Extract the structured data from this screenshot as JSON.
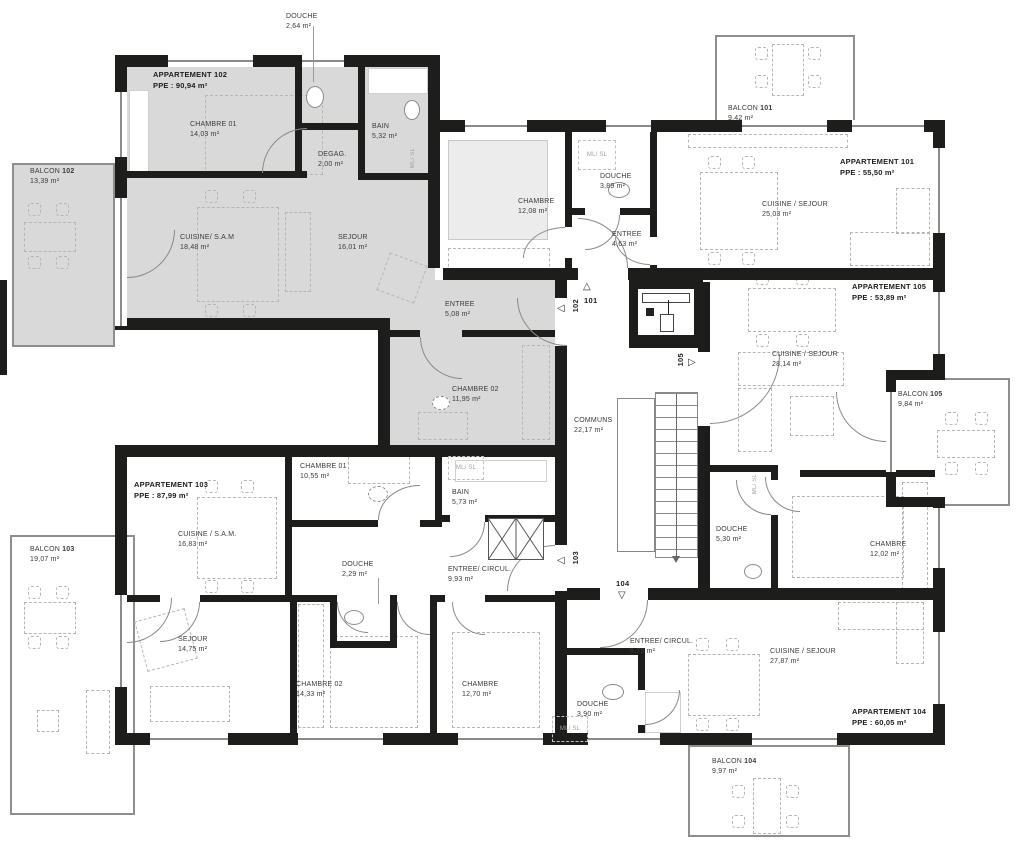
{
  "plan": {
    "apartments": {
      "a101": {
        "title": "APPARTEMENT 101",
        "ppe": "PPE : 55,50 m²"
      },
      "a102": {
        "title": "APPARTEMENT 102",
        "ppe": "PPE : 90,94 m²"
      },
      "a103": {
        "title": "APPARTEMENT 103",
        "ppe": "PPE : 87,99 m²"
      },
      "a104": {
        "title": "APPARTEMENT 104",
        "ppe": "PPE : 60,05 m²"
      },
      "a105": {
        "title": "APPARTEMENT 105",
        "ppe": "PPE : 53,89 m²"
      }
    },
    "rooms": {
      "douche_102_top": {
        "name": "DOUCHE",
        "area": "2,64 m²"
      },
      "chambre01_102": {
        "name": "CHAMBRE 01",
        "area": "14,03 m²"
      },
      "bain_102": {
        "name": "BAIN",
        "area": "5,32 m²"
      },
      "degag_102": {
        "name": "DEGAG.",
        "area": "2,00 m²"
      },
      "cuisine_102": {
        "name": "CUISINE/ S.A.M",
        "area": "18,48 m²"
      },
      "sejour_102": {
        "name": "SEJOUR",
        "area": "16,01 m²"
      },
      "entree_102": {
        "name": "ENTREE",
        "area": "5,08 m²"
      },
      "chambre02_102": {
        "name": "CHAMBRE 02",
        "area": "11,95 m²"
      },
      "chambre_101": {
        "name": "CHAMBRE",
        "area": "12,08 m²"
      },
      "douche_101": {
        "name": "DOUCHE",
        "area": "3,89 m²"
      },
      "entree_101": {
        "name": "ENTREE",
        "area": "4,63 m²"
      },
      "cuisine_101": {
        "name": "CUISINE / SEJOUR",
        "area": "25,03 m²"
      },
      "cuisine_105": {
        "name": "CUISINE / SEJOUR",
        "area": "28,14 m²"
      },
      "douche_105": {
        "name": "DOUCHE",
        "area": "5,30 m²"
      },
      "chambre_105": {
        "name": "CHAMBRE",
        "area": "12,02 m²"
      },
      "communs": {
        "name": "COMMUNS",
        "area": "22,17 m²"
      },
      "chambre01_103": {
        "name": "CHAMBRE 01",
        "area": "10,55 m²"
      },
      "bain_103": {
        "name": "BAIN",
        "area": "5,73 m²"
      },
      "cuisine_103": {
        "name": "CUISINE / S.A.M.",
        "area": "16,83 m²"
      },
      "douche_103": {
        "name": "DOUCHE",
        "area": "2,29 m²"
      },
      "entree_103": {
        "name": "ENTREE/ CIRCUL.",
        "area": "9,93 m²"
      },
      "sejour_103": {
        "name": "SEJOUR",
        "area": "14,75 m²"
      },
      "chambre02_103": {
        "name": "CHAMBRE 02",
        "area": "14,33 m²"
      },
      "chambre_103": {
        "name": "CHAMBRE",
        "area": "12,70 m²"
      },
      "entree_104": {
        "name": "ENTREE/ CIRCUL.",
        "area": "5,79 m²"
      },
      "cuisine_104": {
        "name": "CUISINE / SEJOUR",
        "area": "27,87 m²"
      },
      "douche_104": {
        "name": "DOUCHE",
        "area": "3,90 m²"
      }
    },
    "balconies": {
      "b101": {
        "name": "BALCON",
        "num": "101",
        "area": "9,42 m²"
      },
      "b102": {
        "name": "BALCON",
        "num": "102",
        "area": "13,39 m²"
      },
      "b103": {
        "name": "BALCON",
        "num": "103",
        "area": "19,07 m²"
      },
      "b104": {
        "name": "BALCON",
        "num": "104",
        "area": "9,97 m²"
      },
      "b105": {
        "name": "BALCON",
        "num": "105",
        "area": "9,84 m²"
      }
    },
    "entries": {
      "e101": "101",
      "e102": "102",
      "e103": "103",
      "e104": "104",
      "e105": "105"
    },
    "icons": {
      "tri_up": "△",
      "tri_down": "▽",
      "tri_left": "◁",
      "tri_right": "▷"
    },
    "misc": {
      "ml_sl": "ML/ SL"
    },
    "colors": {
      "wall": "#1d1d1b",
      "apartment_highlight": "#d9d9d9"
    }
  }
}
